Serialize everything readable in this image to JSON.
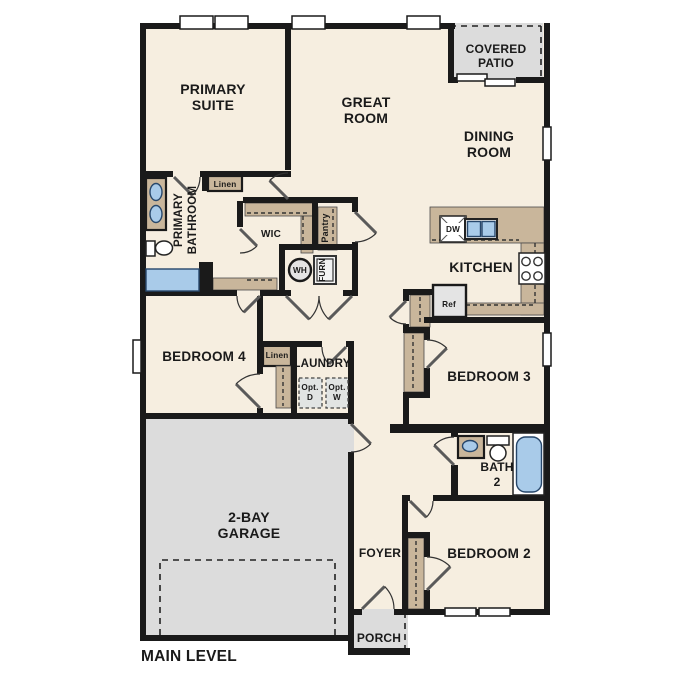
{
  "plan": {
    "level_label": "MAIN LEVEL"
  },
  "rooms": {
    "primary_suite": {
      "line1": "PRIMARY",
      "line2": "SUITE"
    },
    "great_room": {
      "line1": "GREAT",
      "line2": "ROOM"
    },
    "dining_room": {
      "line1": "DINING",
      "line2": "ROOM"
    },
    "covered_patio": {
      "line1": "COVERED",
      "line2": "PATIO"
    },
    "kitchen": {
      "label": "KITCHEN"
    },
    "primary_bathroom": {
      "line1": "PRIMARY",
      "line2": "BATHROOM"
    },
    "wic": {
      "label": "WIC"
    },
    "pantry": {
      "label": "Pantry"
    },
    "linen_bath": {
      "label": "Linen"
    },
    "linen_hall": {
      "label": "Linen"
    },
    "bedroom4": {
      "label": "BEDROOM 4"
    },
    "laundry": {
      "label": "LAUNDRY"
    },
    "bedroom3": {
      "label": "BEDROOM 3"
    },
    "bath2": {
      "line1": "BATH",
      "line2": "2"
    },
    "garage": {
      "line1": "2-BAY",
      "line2": "GARAGE"
    },
    "foyer": {
      "label": "FOYER"
    },
    "bedroom2": {
      "label": "BEDROOM 2"
    },
    "porch": {
      "label": "PORCH"
    }
  },
  "appliances": {
    "water_heater": "WH",
    "furnace": "FURN",
    "dishwasher": "DW",
    "refrigerator": "Ref",
    "opt_dryer": {
      "line1": "Opt.",
      "line2": "D"
    },
    "opt_washer": {
      "line1": "Opt.",
      "line2": "W"
    }
  },
  "colors": {
    "floor": "#f6eee0",
    "outdoor_concrete": "#dcdcdc",
    "casework_tan": "#c9b69b",
    "wall_black": "#1a1a1a",
    "fixture_blue": "#a9cbe9",
    "appliance_gray": "#e4e4e4",
    "text": "#1a1a1a"
  }
}
